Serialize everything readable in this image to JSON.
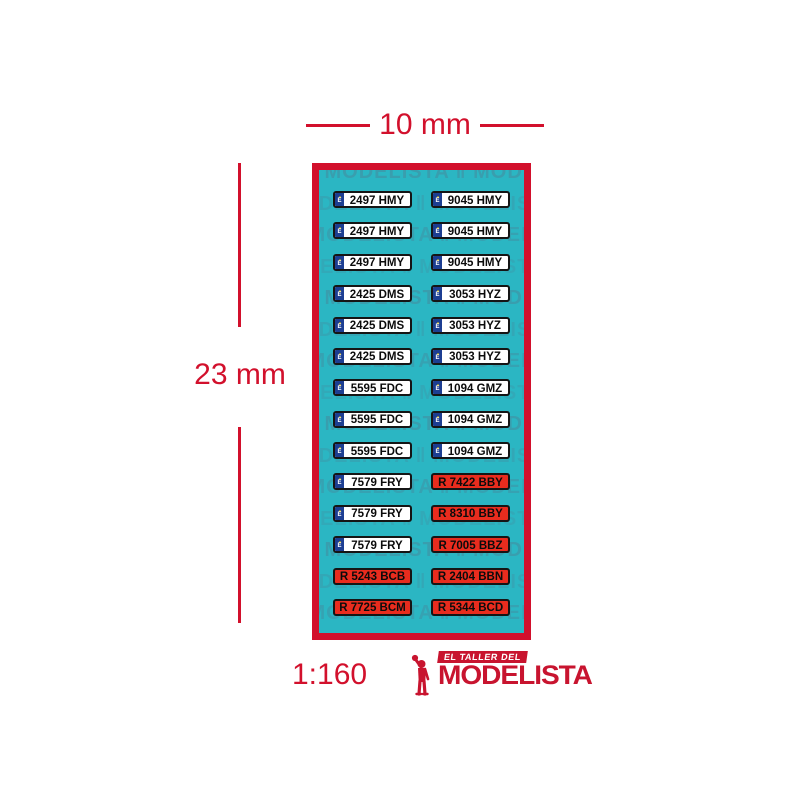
{
  "colors": {
    "accent_red": "#d2102c",
    "teal_background": "#2bb6c3",
    "watermark_teal": "#47889b",
    "plate_red": "#e92c1e",
    "eu_band_blue": "#1c3e92",
    "eu_star_yellow": "#ffd500",
    "logo_red": "#c8142f"
  },
  "dimensions": {
    "width_label": "10 mm",
    "height_label": "23 mm"
  },
  "scale_label": "1:160",
  "plate_sheet": {
    "eu_band_letter": "E",
    "eu_band_stars": "•••",
    "rows": [
      {
        "left": {
          "text": "2497 HMY",
          "style": "white"
        },
        "right": {
          "text": "9045 HMY",
          "style": "white"
        }
      },
      {
        "left": {
          "text": "2497 HMY",
          "style": "white"
        },
        "right": {
          "text": "9045 HMY",
          "style": "white"
        }
      },
      {
        "left": {
          "text": "2497 HMY",
          "style": "white"
        },
        "right": {
          "text": "9045 HMY",
          "style": "white"
        }
      },
      {
        "left": {
          "text": "2425 DMS",
          "style": "white"
        },
        "right": {
          "text": "3053 HYZ",
          "style": "white"
        }
      },
      {
        "left": {
          "text": "2425 DMS",
          "style": "white"
        },
        "right": {
          "text": "3053 HYZ",
          "style": "white"
        }
      },
      {
        "left": {
          "text": "2425 DMS",
          "style": "white"
        },
        "right": {
          "text": "3053 HYZ",
          "style": "white"
        }
      },
      {
        "left": {
          "text": "5595 FDC",
          "style": "white"
        },
        "right": {
          "text": "1094 GMZ",
          "style": "white"
        }
      },
      {
        "left": {
          "text": "5595 FDC",
          "style": "white"
        },
        "right": {
          "text": "1094 GMZ",
          "style": "white"
        }
      },
      {
        "left": {
          "text": "5595 FDC",
          "style": "white"
        },
        "right": {
          "text": "1094 GMZ",
          "style": "white"
        }
      },
      {
        "left": {
          "text": "7579 FRY",
          "style": "white"
        },
        "right": {
          "text": "R 7422 BBY",
          "style": "red"
        }
      },
      {
        "left": {
          "text": "7579 FRY",
          "style": "white"
        },
        "right": {
          "text": "R 8310 BBY",
          "style": "red"
        }
      },
      {
        "left": {
          "text": "7579 FRY",
          "style": "white"
        },
        "right": {
          "text": "R 7005 BBZ",
          "style": "red"
        }
      },
      {
        "left": {
          "text": "R 5243 BCB",
          "style": "red"
        },
        "right": {
          "text": "R 2404 BBN",
          "style": "red"
        }
      },
      {
        "left": {
          "text": "R 7725 BCM",
          "style": "red"
        },
        "right": {
          "text": "R 5344 BCD",
          "style": "red"
        }
      }
    ]
  },
  "watermark": {
    "text": "MODELISTA",
    "separator": "‖"
  },
  "logo": {
    "tagline": "EL TALLER DEL",
    "name": "MODELISTA"
  }
}
